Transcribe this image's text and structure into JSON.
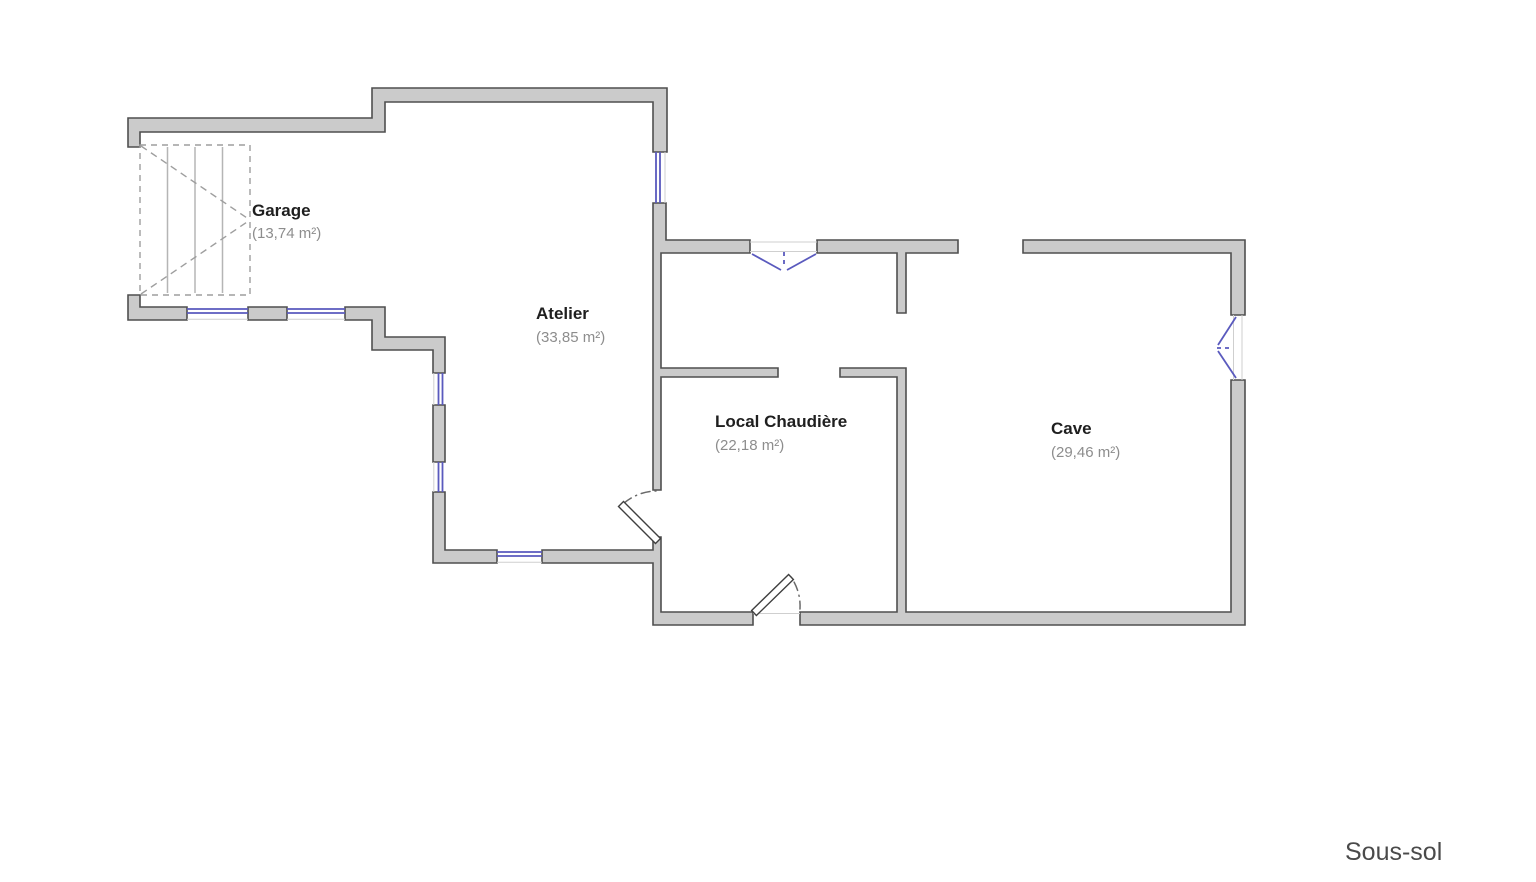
{
  "floor_label": "Sous-sol",
  "rooms": [
    {
      "name": "Garage",
      "area": "(13,74 m²)"
    },
    {
      "name": "Atelier",
      "area": "(33,85 m²)"
    },
    {
      "name": "Local Chaudière",
      "area": "(22,18 m²)"
    },
    {
      "name": "Cave",
      "area": "(29,46 m²)"
    }
  ],
  "colors": {
    "background": "#ffffff",
    "wall_fill": "#cbcbcb",
    "wall_stroke": "#4f4f4f",
    "window_blue": "#5a5abe",
    "stair_gray": "#9e9e9e",
    "room_name_color": "#1f1f1f",
    "room_area_color": "#8d8d8d",
    "floor_label_color": "#4a4a4a"
  }
}
